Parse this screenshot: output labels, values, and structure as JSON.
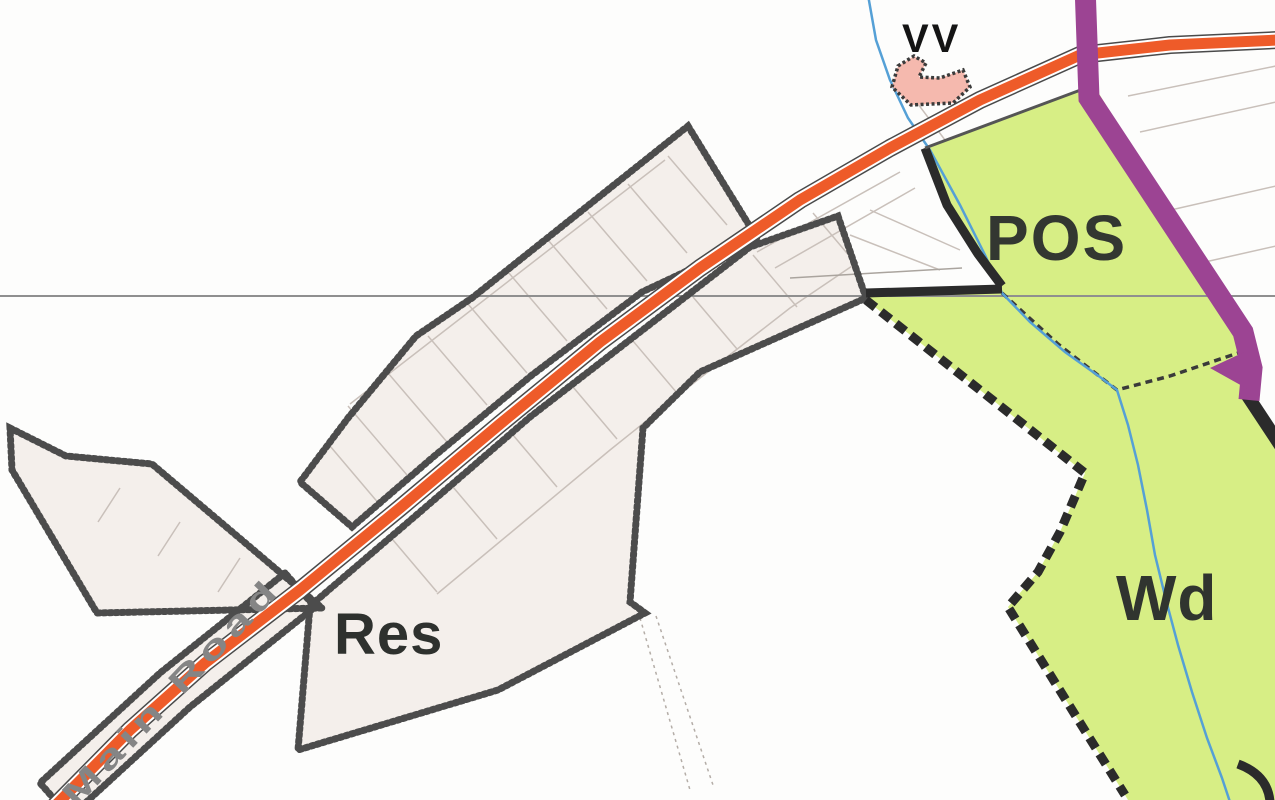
{
  "map": {
    "title": "Settlement proposals map extract",
    "labels": {
      "residential": "Res",
      "public_open_space": "POS",
      "woodland": "Wd",
      "road_name": "Main Road",
      "boundary_marks": "VV"
    },
    "colors": {
      "background": "#fdfdfc",
      "residential_fill": "#f4efeb",
      "green_fill": "#d7ee85",
      "road_orange": "#ee5b29",
      "road_casing": "#4a4a4a",
      "purple_route": "#9c4493",
      "pink_area": "#f5b9ae",
      "stream_blue": "#55a0d6",
      "boundary_dark": "#3c3c3c",
      "green_boundary": "#2b2b2b",
      "parcel_line": "#c9c0ba",
      "grid_line": "#8f8f8f",
      "label_dark": "#30342f",
      "road_text_gray": "#858585"
    }
  }
}
